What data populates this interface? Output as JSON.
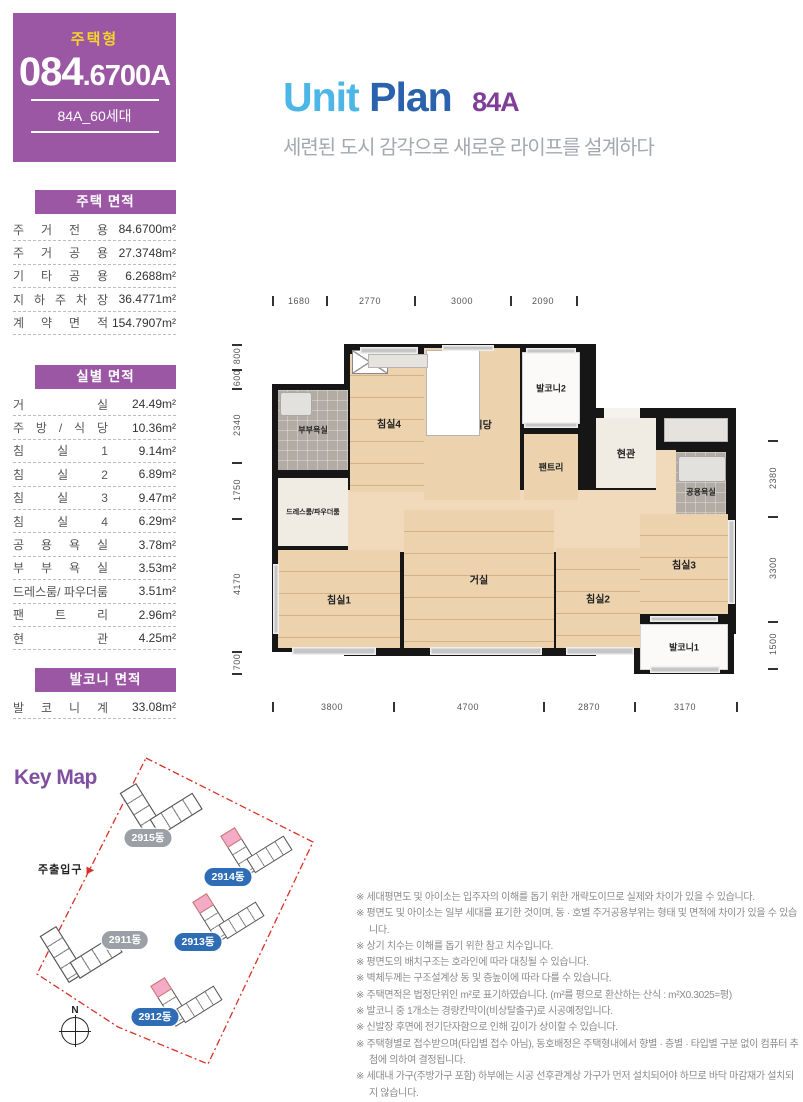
{
  "badge": {
    "type_label": "주택형",
    "code_main": "084",
    "code_tail": ".6700A",
    "units": "84A_60세대"
  },
  "title": {
    "word1": "Unit",
    "word2": "Plan",
    "code": "84A",
    "subtitle": "세련된 도시 감각으로 새로운 라이프를 설계하다"
  },
  "area_tables": [
    {
      "title": "주택 면적",
      "rows": [
        {
          "label": "주 거 전 용",
          "value": "84.6700m²"
        },
        {
          "label": "주 거 공 용",
          "value": "27.3748m²"
        },
        {
          "label": "기 타 공 용",
          "value": "6.2688m²"
        },
        {
          "label": "지 하 주 차 장",
          "value": "36.4771m²"
        },
        {
          "label": "계 약 면 적",
          "value": "154.7907m²"
        }
      ]
    },
    {
      "title": "실별 면적",
      "rows": [
        {
          "label": "거 실",
          "value": "24.49m²"
        },
        {
          "label": "주 방 / 식 당",
          "value": "10.36m²"
        },
        {
          "label": "침 실 1",
          "value": "9.14m²"
        },
        {
          "label": "침 실 2",
          "value": "6.89m²"
        },
        {
          "label": "침 실 3",
          "value": "9.47m²"
        },
        {
          "label": "침 실 4",
          "value": "6.29m²"
        },
        {
          "label": "공 용 욕 실",
          "value": "3.78m²"
        },
        {
          "label": "부 부 욕 실",
          "value": "3.53m²"
        },
        {
          "label": "드레스룸/ 파우더룸",
          "value": "3.51m²"
        },
        {
          "label": "팬 트 리",
          "value": "2.96m²"
        },
        {
          "label": "현 관",
          "value": "4.25m²"
        }
      ]
    },
    {
      "title": "발코니 면적",
      "rows": [
        {
          "label": "발 코 니 계",
          "value": "33.08m²"
        }
      ]
    }
  ],
  "floor_plan": {
    "walls": [
      {
        "x": 0,
        "y": 40,
        "w": 84,
        "h": 268
      },
      {
        "x": 72,
        "y": 0,
        "w": 252,
        "h": 312
      },
      {
        "x": 244,
        "y": 2,
        "w": 70,
        "h": 88
      },
      {
        "x": 310,
        "y": 64,
        "w": 154,
        "h": 226
      },
      {
        "x": 362,
        "y": 276,
        "w": 100,
        "h": 54
      }
    ],
    "rooms": [
      {
        "name": "corridor-1",
        "x": 76,
        "y": 146,
        "w": 240,
        "h": 62,
        "fill": "wood2"
      },
      {
        "name": "corridor-2",
        "x": 316,
        "y": 146,
        "w": 68,
        "h": 62,
        "fill": "wood2"
      },
      {
        "name": "corridor-3",
        "x": 384,
        "y": 106,
        "w": 20,
        "h": 102,
        "fill": "wood2"
      },
      {
        "name": "corridor-4",
        "x": 384,
        "y": 184,
        "w": 70,
        "h": 24,
        "fill": "wood2"
      },
      {
        "name": "bedroom4",
        "label": "침실4",
        "x": 78,
        "y": 10,
        "w": 78,
        "h": 138,
        "fill": "wood planks",
        "fs": 10
      },
      {
        "name": "kitchen-dining",
        "label": "주방/식당",
        "x": 152,
        "y": 4,
        "w": 96,
        "h": 152,
        "fill": "wood",
        "fs": 10
      },
      {
        "name": "balcony2",
        "label": "발코니2",
        "x": 250,
        "y": 8,
        "w": 58,
        "h": 72,
        "fill": "white",
        "fs": 9
      },
      {
        "name": "pantry",
        "label": "팬트리",
        "x": 252,
        "y": 90,
        "w": 54,
        "h": 66,
        "fill": "wood",
        "fs": 9
      },
      {
        "name": "entry",
        "label": "현관",
        "x": 324,
        "y": 74,
        "w": 60,
        "h": 70,
        "fill": "light",
        "fs": 10
      },
      {
        "name": "bath-common",
        "label": "공용욕실",
        "x": 404,
        "y": 108,
        "w": 50,
        "h": 80,
        "fill": "tile",
        "fs": 8
      },
      {
        "name": "bath-couple",
        "label": "부부욕실",
        "x": 6,
        "y": 46,
        "w": 70,
        "h": 80,
        "fill": "tile",
        "fs": 8
      },
      {
        "name": "dressroom-powder",
        "label": "드레스룸/파우더룸",
        "x": 6,
        "y": 134,
        "w": 70,
        "h": 68,
        "fill": "light",
        "fs": 7
      },
      {
        "name": "bedroom1",
        "label": "침실1",
        "x": 6,
        "y": 206,
        "w": 122,
        "h": 98,
        "fill": "wood planks",
        "fs": 10
      },
      {
        "name": "living",
        "label": "거실",
        "x": 132,
        "y": 166,
        "w": 150,
        "h": 138,
        "fill": "wood planks",
        "fs": 10
      },
      {
        "name": "bedroom2",
        "label": "침실2",
        "x": 284,
        "y": 204,
        "w": 84,
        "h": 100,
        "fill": "wood planks",
        "fs": 10
      },
      {
        "name": "bedroom3",
        "label": "침실3",
        "x": 368,
        "y": 170,
        "w": 88,
        "h": 100,
        "fill": "wood planks",
        "fs": 10
      },
      {
        "name": "balcony1",
        "label": "발코니1",
        "x": 368,
        "y": 280,
        "w": 88,
        "h": 46,
        "fill": "white",
        "fs": 9
      }
    ],
    "details": [
      {
        "type": "counter",
        "x": 154,
        "y": 6,
        "w": 52,
        "h": 84
      },
      {
        "type": "xbox",
        "x": 80,
        "y": 6,
        "w": 34,
        "h": 22
      },
      {
        "type": "closet",
        "x": 96,
        "y": 10,
        "w": 58,
        "h": 12
      },
      {
        "type": "closet",
        "x": 392,
        "y": 74,
        "w": 62,
        "h": 22
      },
      {
        "type": "tub",
        "x": 406,
        "y": 112,
        "w": 46,
        "h": 24
      },
      {
        "type": "tub",
        "x": 8,
        "y": 48,
        "w": 30,
        "h": 22
      },
      {
        "type": "opening",
        "x": 332,
        "y": 64,
        "w": 36,
        "h": 10
      }
    ],
    "windows": [
      {
        "x": 20,
        "y": 303,
        "w": 84,
        "h": 8
      },
      {
        "x": 158,
        "y": 303,
        "w": 112,
        "h": 8
      },
      {
        "x": 294,
        "y": 303,
        "w": 68,
        "h": 8
      },
      {
        "x": 378,
        "y": 322,
        "w": 70,
        "h": 7
      },
      {
        "x": 88,
        "y": 3,
        "w": 58,
        "h": 7
      },
      {
        "x": 170,
        "y": 1,
        "w": 52,
        "h": 6
      },
      {
        "x": 254,
        "y": 4,
        "w": 50,
        "h": 6
      },
      {
        "x": 252,
        "y": 78,
        "w": 54,
        "h": 6
      },
      {
        "x": 378,
        "y": 272,
        "w": 68,
        "h": 6
      },
      {
        "x": 456,
        "y": 176,
        "w": 7,
        "h": 84
      },
      {
        "x": 1,
        "y": 220,
        "w": 6,
        "h": 70
      }
    ],
    "dims": [
      {
        "side": "top",
        "labels": [
          {
            "t": "1680",
            "c": 27
          },
          {
            "t": "2770",
            "c": 98
          },
          {
            "t": "3000",
            "c": 190
          },
          {
            "t": "2090",
            "c": 271
          }
        ],
        "ticks": [
          0,
          54,
          142,
          238,
          304
        ]
      },
      {
        "side": "bottom",
        "labels": [
          {
            "t": "3800",
            "c": 60
          },
          {
            "t": "4700",
            "c": 196
          },
          {
            "t": "2870",
            "c": 317
          },
          {
            "t": "3170",
            "c": 413
          }
        ],
        "ticks": [
          0,
          121,
          271,
          362,
          464
        ]
      },
      {
        "side": "left",
        "labels": [
          {
            "t": "800",
            "c": 12
          },
          {
            "t": "600",
            "c": 34
          },
          {
            "t": "2340",
            "c": 81
          },
          {
            "t": "1750",
            "c": 146
          },
          {
            "t": "4170",
            "c": 240
          },
          {
            "t": "700",
            "c": 318
          }
        ],
        "ticks": [
          0,
          25,
          44,
          118,
          174,
          307,
          329
        ]
      },
      {
        "side": "right",
        "labels": [
          {
            "t": "2380",
            "c": 134
          },
          {
            "t": "3300",
            "c": 224
          },
          {
            "t": "1500",
            "c": 300
          }
        ],
        "ticks": [
          96,
          172,
          277,
          324
        ]
      }
    ]
  },
  "key_map": {
    "title": "Key Map",
    "entrance_label": "주출입구",
    "entrance_arrow": "▶",
    "compass_label": "N",
    "buildings": [
      {
        "label": "2915동",
        "color": "gray",
        "pink": false,
        "x": 153,
        "y": 60,
        "s": 1.15,
        "px": 138,
        "py": 83
      },
      {
        "label": "2914동",
        "color": "blue",
        "pink": true,
        "x": 248,
        "y": 100,
        "s": 1,
        "px": 218,
        "py": 122
      },
      {
        "label": "2911동",
        "color": "gray",
        "pink": false,
        "x": 73,
        "y": 203,
        "s": 1.15,
        "px": 115,
        "py": 185
      },
      {
        "label": "2913동",
        "color": "blue",
        "pink": true,
        "x": 220,
        "y": 166,
        "s": 1,
        "px": 188,
        "py": 187
      },
      {
        "label": "2912동",
        "color": "blue",
        "pink": true,
        "x": 178,
        "y": 250,
        "s": 1,
        "px": 145,
        "py": 262
      }
    ]
  },
  "notes": [
    "※ 세대평면도 및 아이소는 입주자의 이해를 돕기 위한 개략도이므로 실제와 차이가 있을 수 있습니다.",
    "※ 평면도 및 아이소는 일부 세대를 표기한 것이며, 동 · 호별 주거공용부위는 형태 및 면적에 차이가 있을 수 있습니다.",
    "※ 상기 치수는 이해를 돕기 위한 참고 치수입니다.",
    "※ 평면도의 배치구조는 호라인에 따라 대칭될 수 있습니다.",
    "※ 벽체두께는 구조설계상 동 및 층높이에 따라 다를 수 있습니다.",
    "※ 주택면적은 법정단위인 m²로 표기하였습니다. (m²를 평으로 환산하는 산식 : m²X0.3025=평)",
    "※ 발코니 중 1개소는 경량칸막이(비상탈출구)로 시공예정입니다.",
    "※ 신발장 후면에 전기단자함으로 인해 깊이가 상이할 수 있습니다.",
    "※ 주택형별로 접수받으며(타입별 접수 아님), 동호배정은 주택형내에서 향별 · 층별 · 타입별 구분 없이 컴퓨터 추첨에 의하여 결정됩니다.",
    "※ 세대내 가구(주방가구 포함) 하부에는 시공 선후관계상 가구가 먼저 설치되어야 하므로 바닥 마감재가 설치되지 않습니다."
  ]
}
